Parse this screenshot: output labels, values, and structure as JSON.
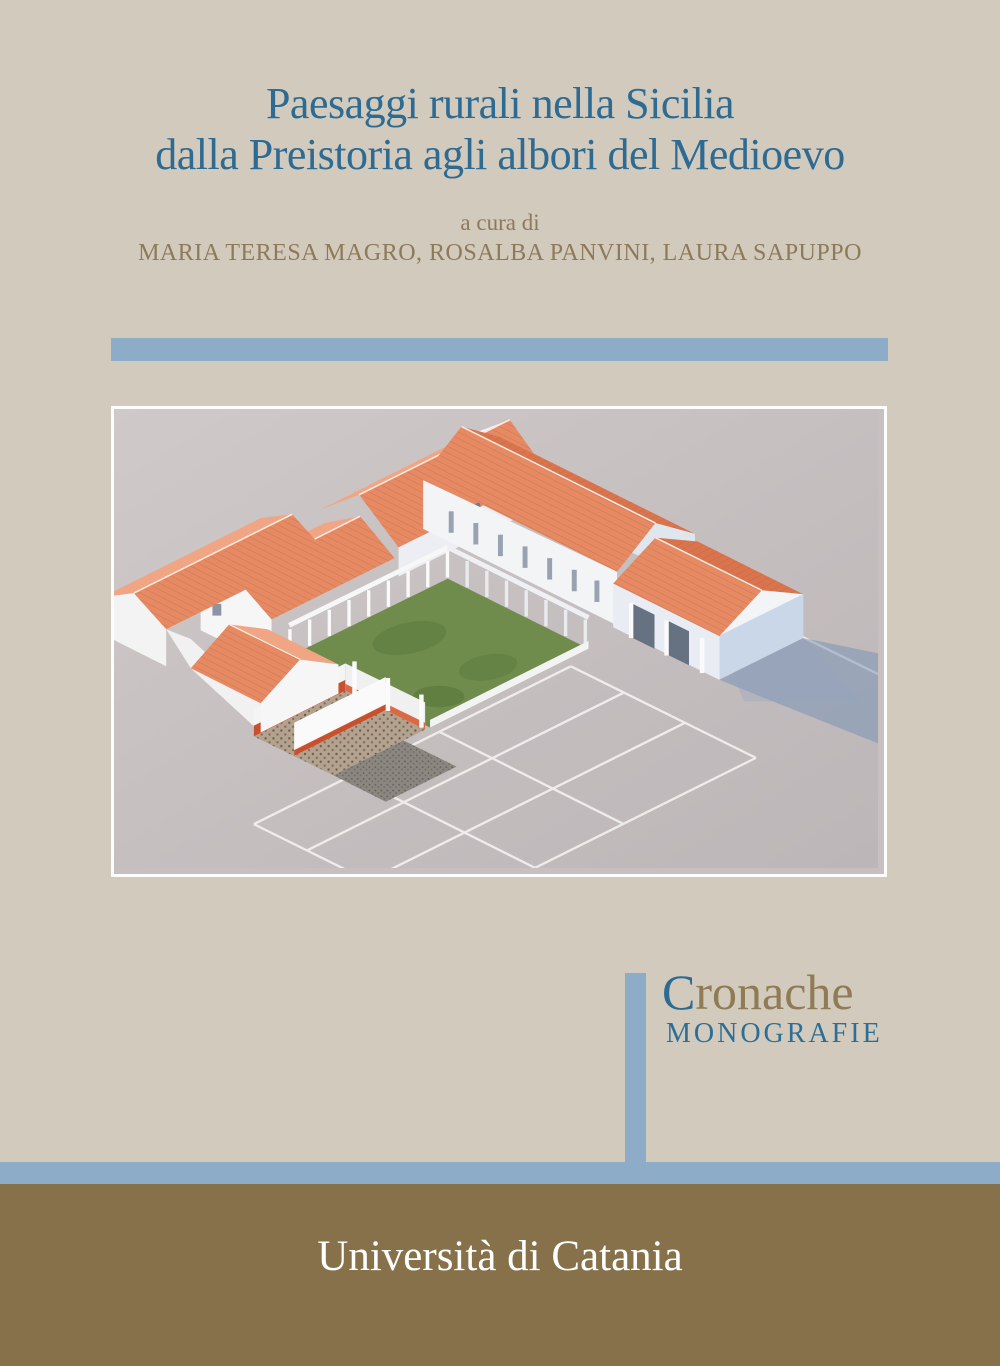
{
  "cover": {
    "title_line1": "Paesaggi rurali nella Sicilia",
    "title_line2": "dalla Preistoria agli albori del Medioevo",
    "curated_by": "a cura di",
    "editors": "MARIA TERESA MAGRO, ROSALBA PANVINI, LAURA SAPUPPO",
    "series": {
      "name_initial": "C",
      "name_rest": "ronache",
      "subtitle": "MONOGRAFIE"
    },
    "publisher": "Università di Catania",
    "image_subject": "3D reconstruction of a Roman villa with peristyle courtyard and excavation floor plan",
    "colors": {
      "background": "#d2cabd",
      "accent_blue_bars": "#8dacc8",
      "title_blue": "#2e6b93",
      "text_olive": "#8d7a58",
      "footer_brown": "#86714a",
      "publisher_text": "#ffffff",
      "roof_terracotta": "#e68a64",
      "courtyard_green": "#6f8c4d"
    }
  }
}
